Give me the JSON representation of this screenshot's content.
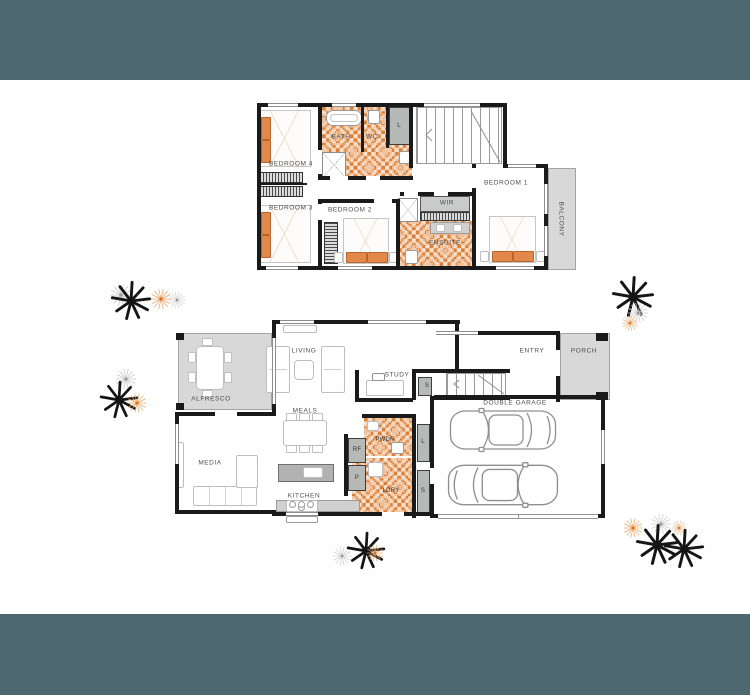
{
  "colors": {
    "band_teal": "#4d686f",
    "wall": "#1a1a1a",
    "tile_accent_orange": "#d97f39",
    "area_gray": "#d7d8d7",
    "plant_orange": "#dd7427",
    "bed_pillow_orange": "#e1884a"
  },
  "upper_floor": {
    "bedroom4": "BEDROOM 4",
    "bedroom3": "BEDROOM 3",
    "bedroom2": "BEDROOM 2",
    "bedroom1": "BEDROOM 1",
    "bath": "BATH",
    "wc": "WC",
    "linen": "L",
    "wir": "WIR",
    "ensuite": "ENSUITE",
    "balcony": "BALCONY"
  },
  "lower_floor": {
    "living": "LIVING",
    "alfresco": "ALFRESCO",
    "meals": "MEALS",
    "kitchen": "KITCHEN",
    "media": "MEDIA",
    "study": "STUDY",
    "entry": "ENTRY",
    "porch": "PORCH",
    "double_garage": "DOUBLE GARAGE",
    "under_stair_store": "S",
    "fridge": "RF",
    "pantry": "P",
    "powder": "PWDR",
    "laundry": "LDRY",
    "linen": "L",
    "store": "S"
  }
}
